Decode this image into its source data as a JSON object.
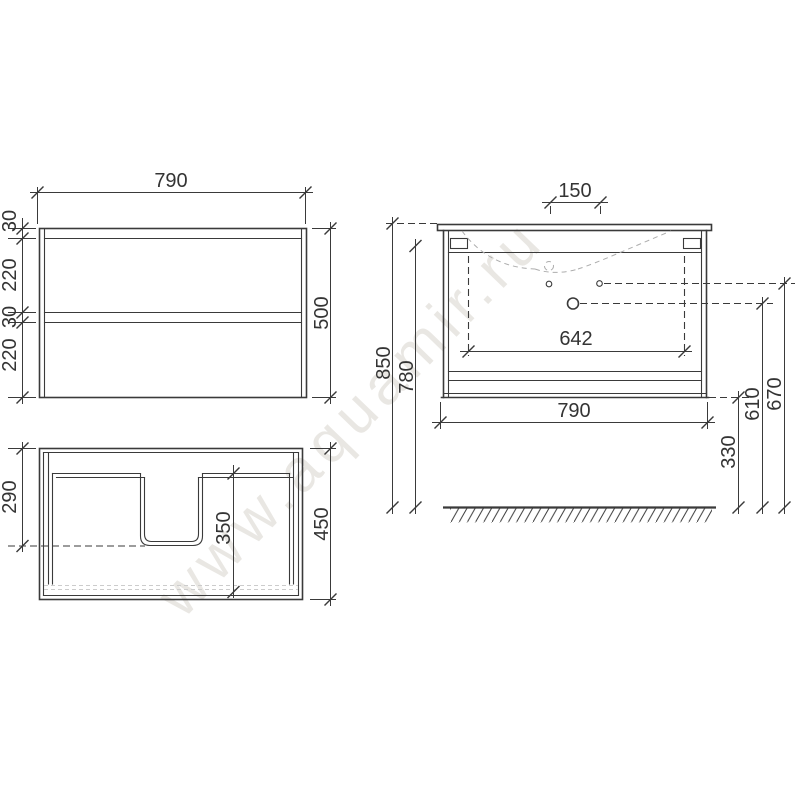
{
  "watermark": {
    "text": "www.aquamir.ru"
  },
  "colors": {
    "background": "#ffffff",
    "line": "#3a3a3a",
    "hidden_line": "#adadad",
    "watermark": "#e9e7e3",
    "text": "#343434"
  },
  "views": {
    "front": {
      "name": "cabinet front view",
      "width": "790",
      "height": "500",
      "segments": [
        "30",
        "220",
        "30",
        "220"
      ]
    },
    "top": {
      "name": "cabinet top view (drawer with U-cutout)",
      "depth": "450",
      "cutout_offset": "290",
      "drawer_inner": "350"
    },
    "side": {
      "name": "front view with basin and installation heights",
      "holes_spacing": "150",
      "span": "642",
      "width": "790",
      "total_height": "850",
      "body_height": "780",
      "floor_clearance": "330",
      "faucet_height": "610",
      "overflow_height": "670"
    }
  }
}
